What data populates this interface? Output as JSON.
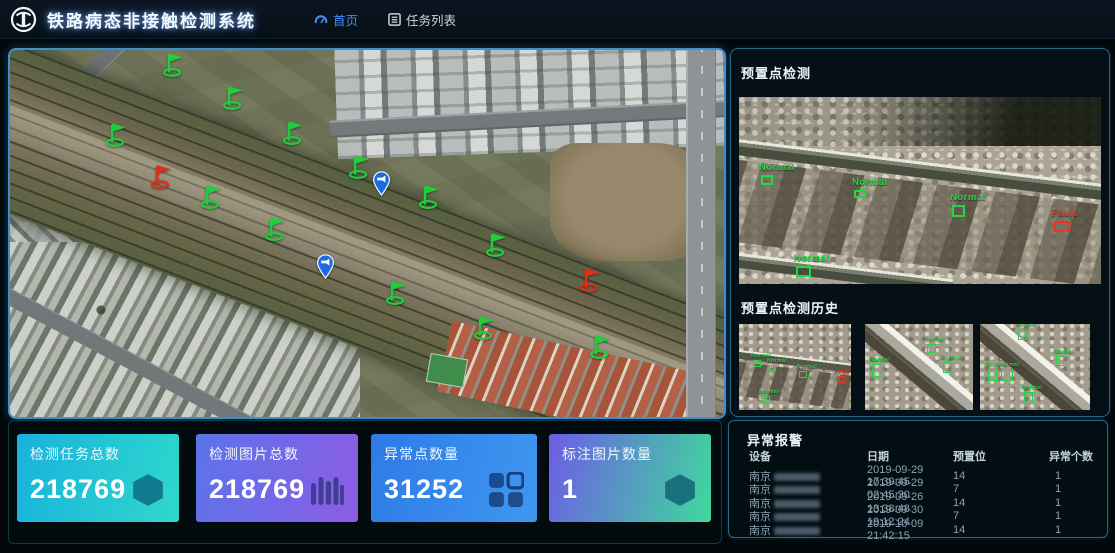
{
  "header": {
    "logo": "china-railway-emblem",
    "title": "铁路病态非接触检测系统",
    "nav": [
      {
        "label": "首页",
        "icon": "dashboard-icon",
        "active": true
      },
      {
        "label": "任务列表",
        "icon": "task-list-icon",
        "active": false
      }
    ]
  },
  "map": {
    "type": "satellite-map",
    "markers": [
      {
        "type": "flag-green",
        "x": 162,
        "y": 22
      },
      {
        "type": "flag-green",
        "x": 222,
        "y": 55
      },
      {
        "type": "flag-green",
        "x": 105,
        "y": 92
      },
      {
        "type": "flag-green",
        "x": 282,
        "y": 90
      },
      {
        "type": "flag-green",
        "x": 348,
        "y": 124
      },
      {
        "type": "flag-red",
        "x": 150,
        "y": 134
      },
      {
        "type": "pin-blue",
        "x": 372,
        "y": 142
      },
      {
        "type": "flag-green",
        "x": 200,
        "y": 154
      },
      {
        "type": "flag-green",
        "x": 418,
        "y": 154
      },
      {
        "type": "flag-green",
        "x": 264,
        "y": 186
      },
      {
        "type": "flag-green",
        "x": 485,
        "y": 202
      },
      {
        "type": "pin-blue",
        "x": 316,
        "y": 225
      },
      {
        "type": "flag-red",
        "x": 579,
        "y": 237
      },
      {
        "type": "flag-green",
        "x": 385,
        "y": 250
      },
      {
        "type": "flag-green",
        "x": 473,
        "y": 285
      },
      {
        "type": "flag-green",
        "x": 589,
        "y": 304
      }
    ]
  },
  "detection": {
    "title": "预置点检测",
    "image_boxes": [
      {
        "label": "Normal",
        "x": 22,
        "y": 78,
        "w": 12,
        "h": 10,
        "color": "green"
      },
      {
        "label": "Normal",
        "x": 115,
        "y": 93,
        "w": 12,
        "h": 8,
        "color": "green"
      },
      {
        "label": "Normal",
        "x": 213,
        "y": 108,
        "w": 13,
        "h": 12,
        "color": "green"
      },
      {
        "label": "Fault",
        "x": 315,
        "y": 124,
        "w": 15,
        "h": 11,
        "color": "red"
      },
      {
        "label": "Normal",
        "x": 57,
        "y": 169,
        "w": 15,
        "h": 11,
        "color": "green"
      }
    ],
    "history_title": "预置点检测历史",
    "history": [
      {
        "orientation": "horizontal",
        "left": 0,
        "width": 112,
        "boxes": [
          {
            "label": "Normal",
            "x": 14,
            "y": 36,
            "w": 8,
            "h": 7,
            "color": "green"
          },
          {
            "label": "Normal",
            "x": 30,
            "y": 41,
            "w": 7,
            "h": 6,
            "color": "green"
          },
          {
            "label": "Normal",
            "x": 60,
            "y": 47,
            "w": 8,
            "h": 7,
            "color": "green"
          },
          {
            "label": "Fault",
            "x": 98,
            "y": 52,
            "w": 8,
            "h": 7,
            "color": "red"
          },
          {
            "label": "Normal",
            "x": 22,
            "y": 72,
            "w": 9,
            "h": 7,
            "color": "green"
          }
        ]
      },
      {
        "orientation": "diagonal",
        "left": 126,
        "width": 108,
        "boxes": [
          {
            "label": "Normal",
            "x": 7,
            "y": 40,
            "w": 10,
            "h": 13,
            "color": "green"
          },
          {
            "label": "Normal",
            "x": 62,
            "y": 20,
            "w": 9,
            "h": 9,
            "color": "green"
          },
          {
            "label": "Normal",
            "x": 78,
            "y": 38,
            "w": 9,
            "h": 11,
            "color": "green"
          }
        ]
      },
      {
        "orientation": "diagonal",
        "left": 241,
        "width": 110,
        "boxes": [
          {
            "label": "Normal",
            "x": 38,
            "y": 5,
            "w": 9,
            "h": 11,
            "color": "green"
          },
          {
            "label": "Normal",
            "x": 8,
            "y": 45,
            "w": 9,
            "h": 12,
            "color": "green"
          },
          {
            "label": "Normal",
            "x": 21,
            "y": 45,
            "w": 12,
            "h": 12,
            "color": "green"
          },
          {
            "label": "Normal",
            "x": 44,
            "y": 68,
            "w": 9,
            "h": 12,
            "color": "green"
          },
          {
            "label": "Normal",
            "x": 76,
            "y": 32,
            "w": 8,
            "h": 10,
            "color": "green"
          }
        ]
      }
    ]
  },
  "stats": {
    "cards": [
      {
        "label": "检测任务总数",
        "value": "218769",
        "icon": "hexagon-icon",
        "gradient": [
          "#18b2dd",
          "#2fd8cb"
        ]
      },
      {
        "label": "检测图片总数",
        "value": "218769",
        "icon": "bars-icon",
        "gradient": [
          "#5b74e8",
          "#8c5ce6"
        ]
      },
      {
        "label": "异常点数量",
        "value": "31252",
        "icon": "grid-icon",
        "gradient": [
          "#2e7be6",
          "#3f97f0"
        ]
      },
      {
        "label": "标注图片数量",
        "value": "1",
        "icon": "hexagon-icon",
        "gradient": [
          "#6d5ce6",
          "#3fd99c"
        ]
      }
    ]
  },
  "alarms": {
    "title": "异常报警",
    "columns": [
      "设备",
      "日期",
      "预置位",
      "异常个数"
    ],
    "rows": [
      {
        "device": "南京",
        "device_redacted": true,
        "date": "2019-09-29 17:39:45",
        "preset": "14",
        "count": "1"
      },
      {
        "device": "南京",
        "device_redacted": true,
        "date": "2019-09-29 02:45:30",
        "preset": "7",
        "count": "1"
      },
      {
        "device": "南京",
        "device_redacted": true,
        "date": "2019-09-26 13:38:48",
        "preset": "14",
        "count": "1"
      },
      {
        "device": "南京",
        "device_redacted": true,
        "date": "2019-09-30 19:12:24",
        "preset": "7",
        "count": "1"
      },
      {
        "device": "南京",
        "device_redacted": true,
        "date": "2019-10-09 21:42:15",
        "preset": "14",
        "count": "1"
      }
    ]
  },
  "colors": {
    "normal_green": "#21d943",
    "fault_red": "#ee3322",
    "flag_green": "#23cc3e",
    "flag_red": "#de2f16",
    "pin_blue": "#1a6ae0",
    "nav_active": "#3f8ef5",
    "map_border": "#3e8fd0",
    "panel_border": "#25688a"
  }
}
